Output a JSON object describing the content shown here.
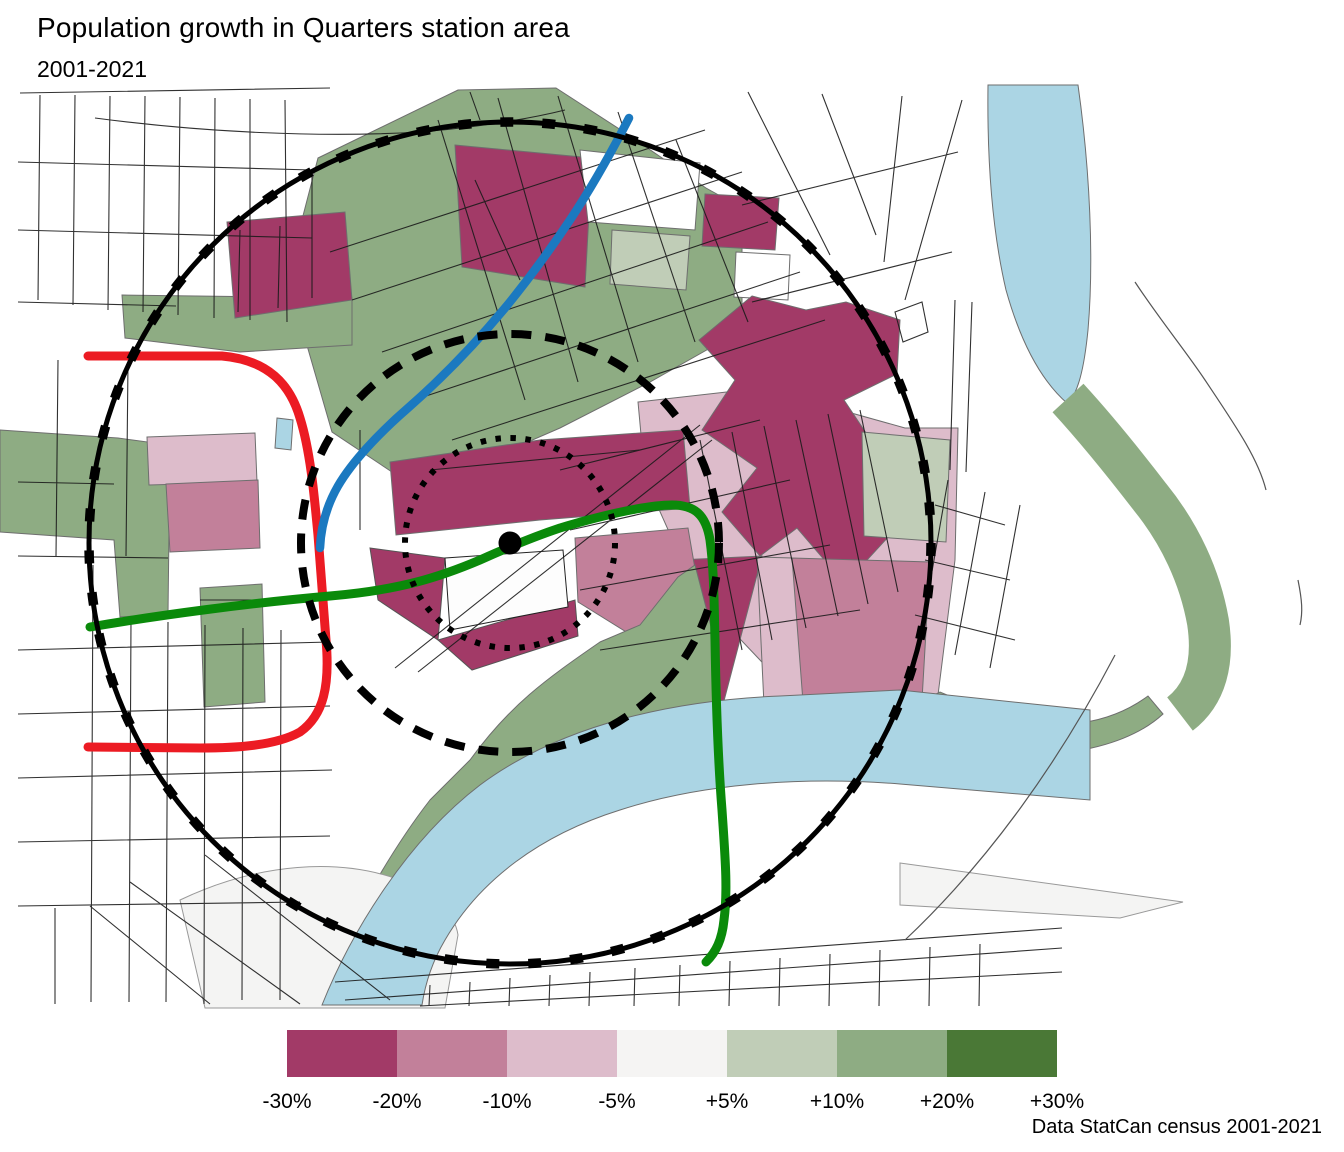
{
  "title": "Population growth in Quarters station area",
  "subtitle": "2001-2021",
  "attribution": "Data StatCan census 2001-2021",
  "legend": {
    "labels": [
      "-30%",
      "-20%",
      "-10%",
      "-5%",
      "+5%",
      "+10%",
      "+20%",
      "+30%"
    ],
    "colors": [
      "#A23A67",
      "#C2809A",
      "#DDBCCB",
      "#F5F4F3",
      "#C0CDB7",
      "#8EAC83",
      "#4A7836"
    ]
  },
  "map": {
    "background_color": "#FFFFFF",
    "water_color": "#ABD5E4",
    "street_color": "#1B1B1B",
    "rings": [
      {
        "name": "outer-ring",
        "style": "solid"
      },
      {
        "name": "middle-ring",
        "style": "dashed"
      },
      {
        "name": "inner-ring",
        "style": "dotted"
      }
    ],
    "routes": [
      {
        "name": "red-route",
        "color": "#EC1B23"
      },
      {
        "name": "blue-route",
        "color": "#1B79C0"
      },
      {
        "name": "green-route",
        "color": "#0A8A0A"
      }
    ],
    "station_marker_color": "#000000",
    "growth_classes": [
      {
        "label": "-30%",
        "color": "#A23A67"
      },
      {
        "label": "-20%",
        "color": "#C2809A"
      },
      {
        "label": "-10%",
        "color": "#DDBCCB"
      },
      {
        "label": "-5% to +5%",
        "color": "#F5F4F3"
      },
      {
        "label": "+10%",
        "color": "#C0CDB7"
      },
      {
        "label": "+20%",
        "color": "#8EAC83"
      },
      {
        "label": "+30%",
        "color": "#4A7836"
      }
    ]
  }
}
